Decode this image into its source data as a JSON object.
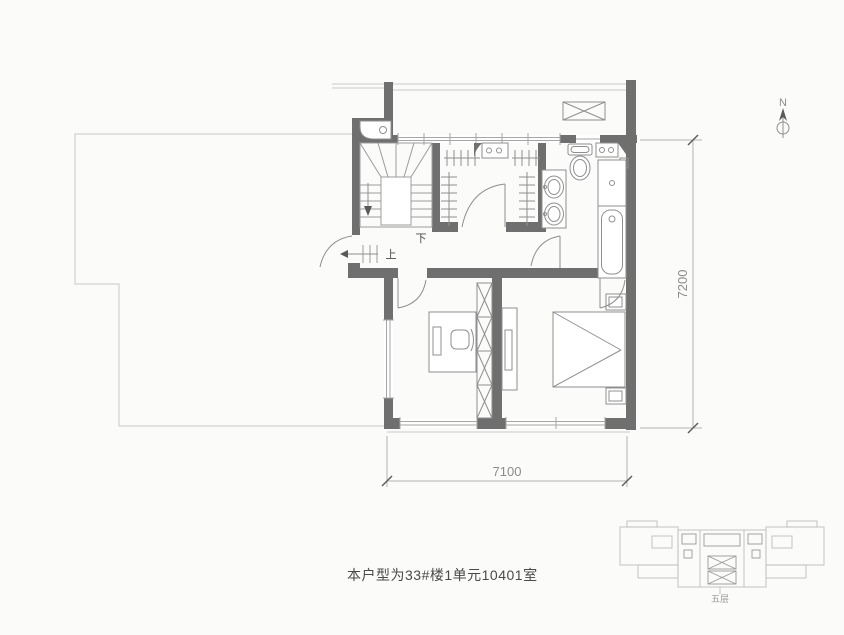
{
  "colors": {
    "bg": "#fbfbfa",
    "wall": "#6f6f6f",
    "line": "#a6a6a6",
    "thin": "#c9c9c9",
    "furn": "#8f8f8f",
    "stair": "#9c9c9c",
    "dim": "#b3b3b3",
    "dimtick": "#5f5f5f",
    "dimtext": "#8c8c8c",
    "text": "#4a4a4a",
    "keyplan": "#bdbdbd",
    "keyplanink": "#9a9a9a"
  },
  "plan": {
    "north_label": "N",
    "stairs": {
      "up_label": "上",
      "down_label": "下"
    },
    "dimensions": {
      "right": "7200",
      "bottom": "7100"
    },
    "caption": "本户型为33#楼1单元10401室",
    "keyplan": {
      "floor_label": "五层"
    }
  }
}
